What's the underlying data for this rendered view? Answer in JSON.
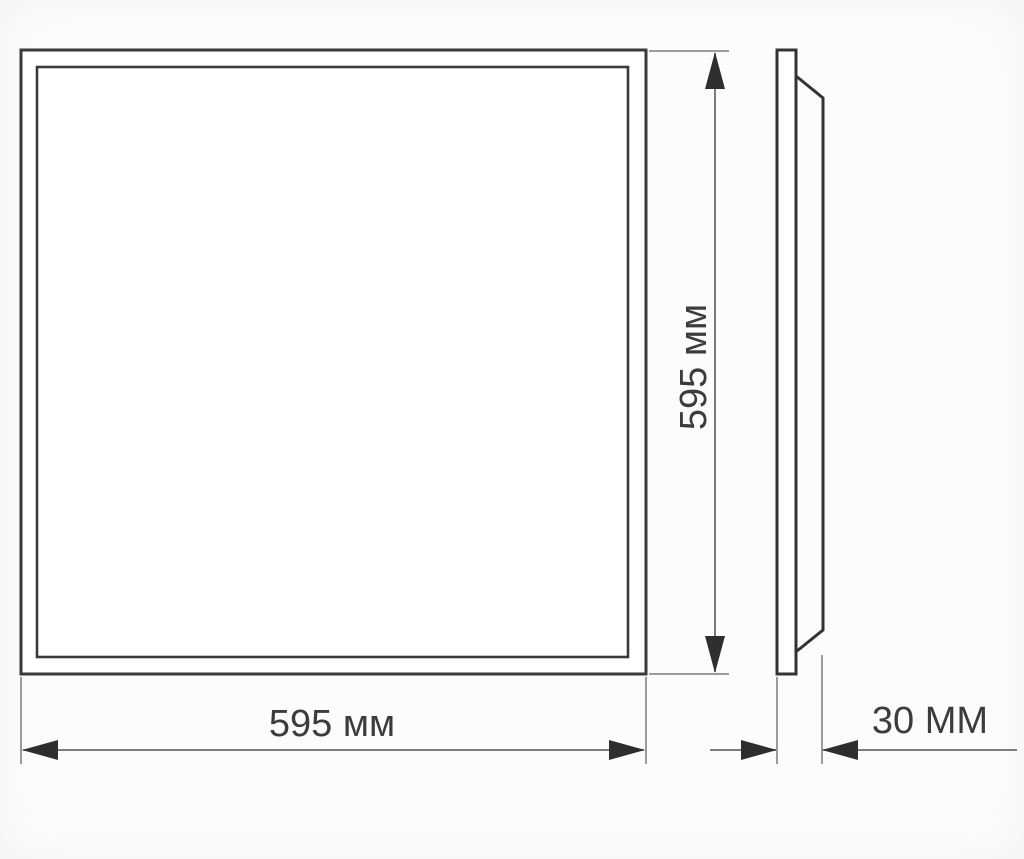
{
  "drawing": {
    "title": "panel dimension drawing",
    "front_view": {
      "width_label": "595 мм",
      "height_label": "595 мм"
    },
    "side_view": {
      "thickness_label": "30 ММ"
    },
    "colors": {
      "outline": "#3a3a3a",
      "extension_line": "#7d7d7d",
      "dimension_line": "#6b6b6b",
      "arrow": "#2e2e2e",
      "label_text": "#3c3c3c",
      "background": "#fcfcfc",
      "panel_fill": "#ffffff"
    }
  }
}
